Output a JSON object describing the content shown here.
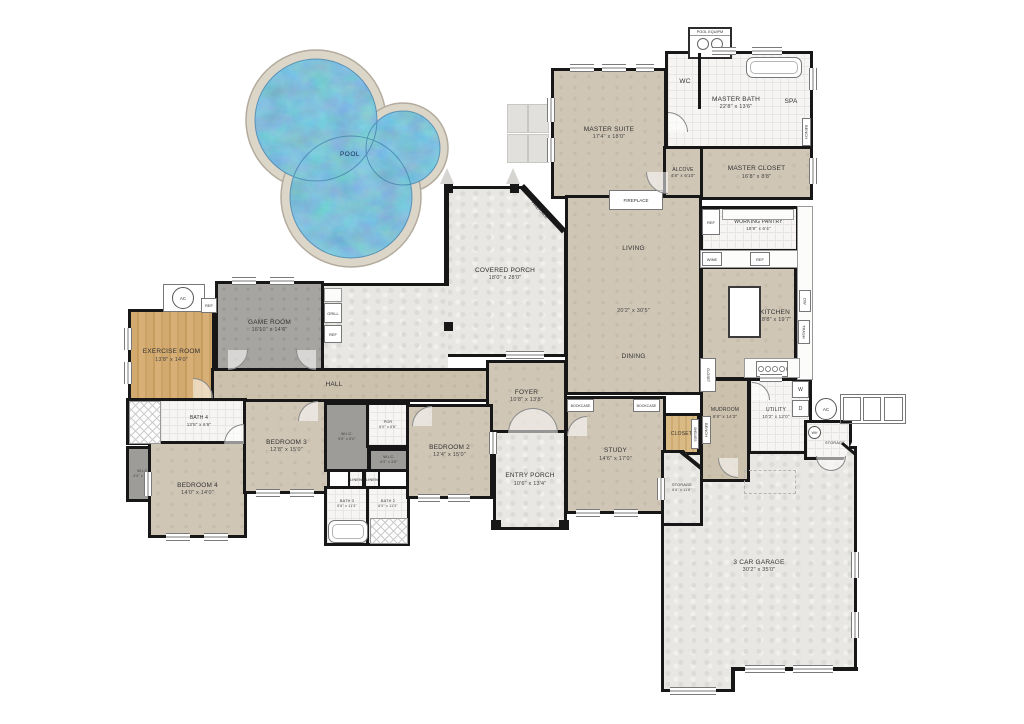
{
  "rooms": {
    "pool": {
      "name": "POOL"
    },
    "pool_equip": {
      "name": "POOL EQUIPM"
    },
    "master_suite": {
      "name": "MASTER SUITE",
      "dims": "17'4\" x 18'0\""
    },
    "wc": {
      "name": "WC"
    },
    "master_bath": {
      "name": "MASTER BATH",
      "dims": "22'8\" x 13'6\""
    },
    "spa": {
      "name": "SPA"
    },
    "master_closet": {
      "name": "MASTER CLOSET",
      "dims": "16'8\" x 8'8\""
    },
    "alcove": {
      "name": "ALCOVE",
      "dims": "4'8\" x 6'10\""
    },
    "living": {
      "name": "LIVING",
      "dims": "20'2\" x 30'5\""
    },
    "dining": {
      "name": "DINING"
    },
    "working_pantry": {
      "name": "WORKING PANTRY",
      "dims": "18'8\" x 6'4\""
    },
    "kitchen": {
      "name": "KITCHEN",
      "dims": "18'8\" x 19'7\""
    },
    "covered_porch": {
      "name": "COVERED PORCH",
      "dims": "18'0\" x 28'0\""
    },
    "game_room": {
      "name": "GAME ROOM",
      "dims": "16'10\" x 14'6\""
    },
    "exercise_room": {
      "name": "EXERCISE ROOM",
      "dims": "13'8\" x 14'0\""
    },
    "hall": {
      "name": "HALL"
    },
    "foyer": {
      "name": "FOYER",
      "dims": "10'8\" x 13'8\""
    },
    "entry_porch": {
      "name": "ENTRY PORCH",
      "dims": "10'6\" x 13'4\""
    },
    "study": {
      "name": "STUDY",
      "dims": "14'6\" x 17'0\""
    },
    "closet_study": {
      "name": "CLOSET"
    },
    "bedroom2": {
      "name": "BEDROOM 2",
      "dims": "12'4\" x 15'0\""
    },
    "bedroom3": {
      "name": "BEDROOM 3",
      "dims": "12'8\" x 15'0\""
    },
    "bedroom4": {
      "name": "BEDROOM 4",
      "dims": "14'0\" x 14'0\""
    },
    "bath2": {
      "name": "BATH 2",
      "dims": "6'0\" x 11'3\""
    },
    "bath3": {
      "name": "BATH 3",
      "dims": "5'6\" x 11'3\""
    },
    "bath4": {
      "name": "BATH 4",
      "dims": "13'8\" x 6'6\""
    },
    "pdr": {
      "name": "PDR",
      "dims": "6'0\" x 6'8\""
    },
    "wic2": {
      "name": "W.I.C.",
      "dims": "6'0\" x 3'8\""
    },
    "wic3": {
      "name": "W.I.C.",
      "dims": "5'6\" x 8'0\""
    },
    "wic4": {
      "name": "W.I.C.",
      "dims": "4'4\" x 6'10\""
    },
    "mudroom": {
      "name": "MUDROOM",
      "dims": "6'8\" x 14'2\""
    },
    "utility": {
      "name": "UTILITY",
      "dims": "10'2\" x 12'0\""
    },
    "storage_hall": {
      "name": "STORAGE",
      "dims": "6'6\" x 11'8\""
    },
    "storage_wh": {
      "name": "STORAGE"
    },
    "garage": {
      "name": "3 CAR GARAGE",
      "dims": "30'2\" x 35'0\""
    }
  },
  "fixtures": {
    "fireplace": "FIREPLACE",
    "bookcase": "BOOKCASE",
    "grill": "GRILL",
    "ref": "REF",
    "wine": "WINE",
    "dw": "DW",
    "trash": "TRASH",
    "washer": "W",
    "dryer": "D",
    "wh": "WH",
    "ac": "AC",
    "bench": "BENCH",
    "linen": "LINEN",
    "closet": "CLOSET",
    "shelves": "SHELVES"
  },
  "colors": {
    "wall": "#171717",
    "pool_water": "#4a8dc2",
    "pool_deck": "#dcd6c9",
    "carpet": "#cfc6b6",
    "stone": "#e8e7e4",
    "wood": "#d2a96e"
  }
}
